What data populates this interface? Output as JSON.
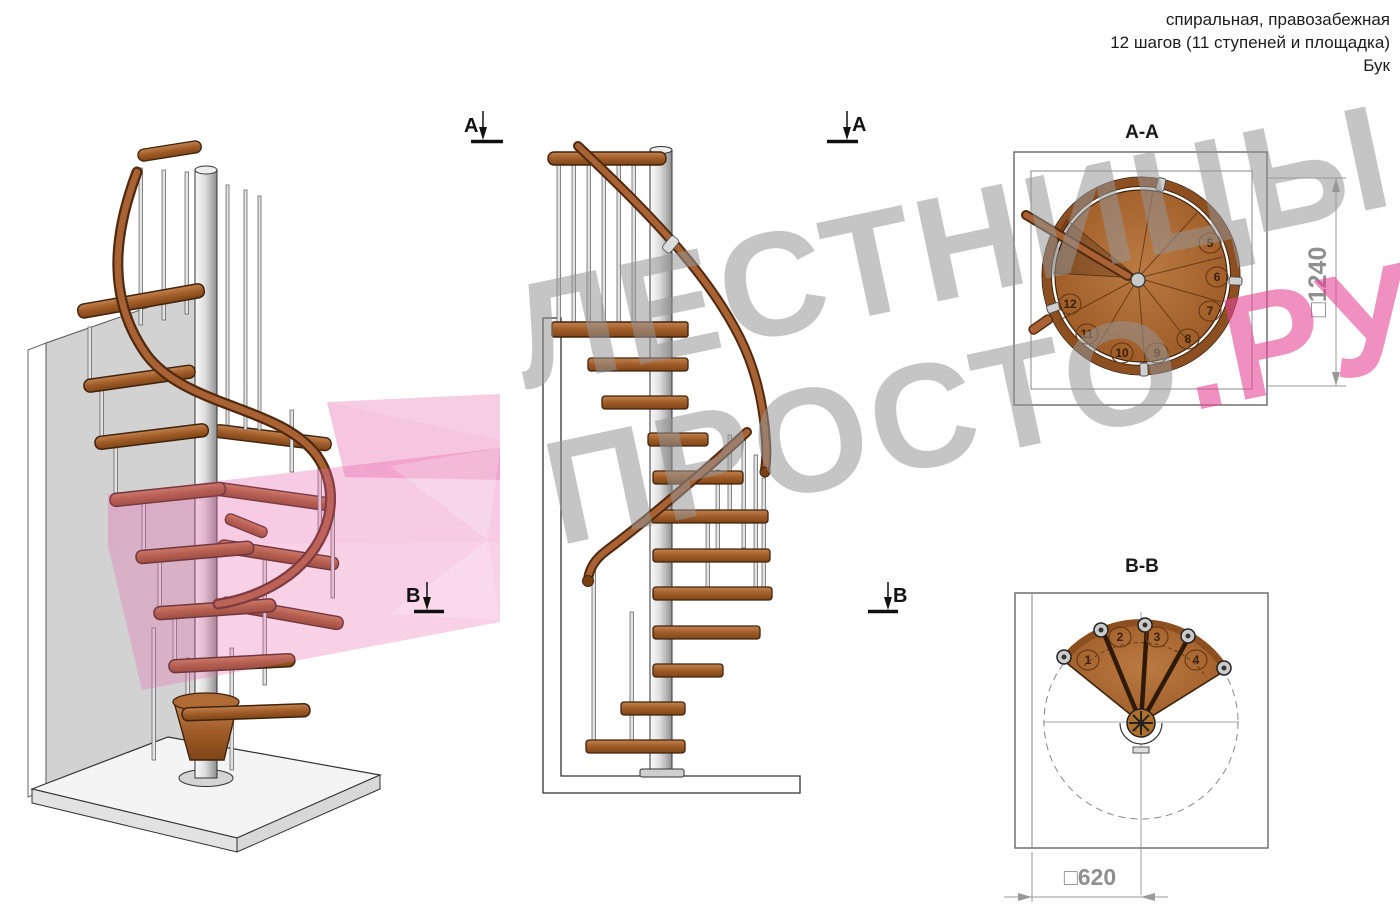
{
  "header": {
    "lines": [
      "спиральная, правозабежная",
      "12 шагов (11 ступеней и площадка)",
      "Бук"
    ]
  },
  "watermark": {
    "line1": "ЛЕСТНИЦЫ",
    "line2_gray": "ПРОСТО",
    "line2_pink": ".РУ"
  },
  "markers": {
    "a": "A",
    "b": "B"
  },
  "sections": {
    "aa": {
      "title": "A-A",
      "dimension": "□1240",
      "steps": [
        "5",
        "6",
        "7",
        "8",
        "9",
        "10",
        "11",
        "12"
      ]
    },
    "bb": {
      "title": "B-B",
      "dimension": "□620",
      "steps": [
        "1",
        "2",
        "3",
        "4"
      ]
    }
  },
  "colors": {
    "wood": "#a96233",
    "wood_dark": "#40230d",
    "metal": "#c9c9c9",
    "watermark_gray": "#cdcdcd",
    "watermark_pink": "#ef9dc4",
    "dimension_gray": "#8f8f8f"
  }
}
